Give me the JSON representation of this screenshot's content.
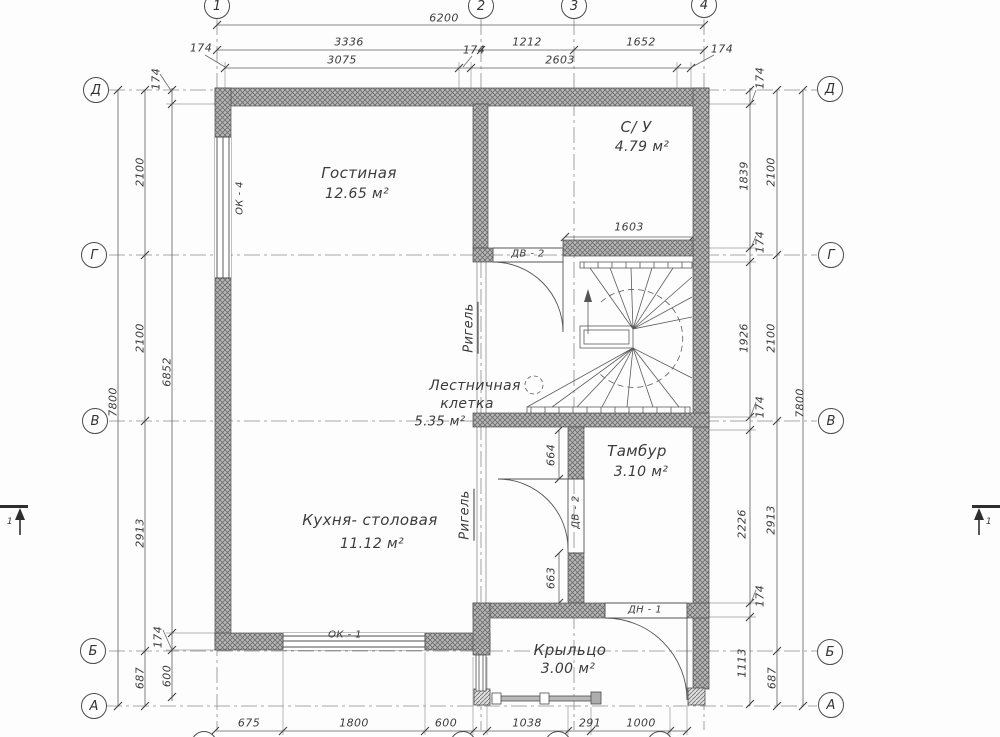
{
  "plan": {
    "type": "floor-plan",
    "rooms": [
      {
        "name": "Гостиная",
        "area": "12.65 м²"
      },
      {
        "name": "С/ У",
        "area": "4.79 м²"
      },
      {
        "name": "Лестничная клетка",
        "area": "5.35 м²"
      },
      {
        "name": "Тамбур",
        "area": "3.10 м²"
      },
      {
        "name": "Кухня- столовая",
        "area": "11.12 м²"
      },
      {
        "name": "Крыльцо",
        "area": "3.00 м²"
      }
    ],
    "axes": {
      "vertical": [
        "1",
        "2",
        "3",
        "4"
      ],
      "horizontal": [
        "Д",
        "Г",
        "В",
        "Б",
        "А"
      ]
    },
    "overall": {
      "width": "6200",
      "height": "7800"
    },
    "colors": {
      "wall_hatch": "#b8b8b8",
      "hatch_line": "#6e6e6e",
      "line": "#4d4d4d",
      "text": "#3b3b3b"
    }
  },
  "labels": [
    {
      "n": "dim-6200",
      "t": "6200",
      "x": 444,
      "y": 18
    },
    {
      "n": "dim-3336",
      "t": "3336",
      "x": 349,
      "y": 42
    },
    {
      "n": "dim-1212",
      "t": "1212",
      "x": 527,
      "y": 42
    },
    {
      "n": "dim-1652",
      "t": "1652",
      "x": 641,
      "y": 42
    },
    {
      "n": "dim-174-top-left",
      "t": "174",
      "x": 201,
      "y": 48
    },
    {
      "n": "dim-3075",
      "t": "3075",
      "x": 342,
      "y": 60
    },
    {
      "n": "dim-174-top-axis2",
      "t": "174",
      "x": 474,
      "y": 50
    },
    {
      "n": "dim-2603",
      "t": "2603",
      "x": 560,
      "y": 60
    },
    {
      "n": "dim-174-top-right",
      "t": "174",
      "x": 722,
      "y": 49
    },
    {
      "n": "dim-7800-left",
      "t": "7800",
      "x": 113,
      "y": 402,
      "r": -90
    },
    {
      "n": "dim-2100-left-a",
      "t": "2100",
      "x": 140,
      "y": 172,
      "r": -90
    },
    {
      "n": "dim-2100-left-b",
      "t": "2100",
      "x": 140,
      "y": 338,
      "r": -90
    },
    {
      "n": "dim-2913-left",
      "t": "2913",
      "x": 140,
      "y": 533,
      "r": -90
    },
    {
      "n": "dim-687-left",
      "t": "687",
      "x": 140,
      "y": 678,
      "r": -90
    },
    {
      "n": "dim-174-left-top",
      "t": "174",
      "x": 156,
      "y": 79,
      "r": -90
    },
    {
      "n": "dim-6852",
      "t": "6852",
      "x": 167,
      "y": 372,
      "r": -90
    },
    {
      "n": "dim-174-left-bottom",
      "t": "174",
      "x": 158,
      "y": 637,
      "r": -90
    },
    {
      "n": "dim-600-left",
      "t": "600",
      "x": 167,
      "y": 676,
      "r": -90
    },
    {
      "n": "dim-174-right-1",
      "t": "174",
      "x": 760,
      "y": 78,
      "r": -90
    },
    {
      "n": "dim-1839",
      "t": "1839",
      "x": 744,
      "y": 176,
      "r": -90
    },
    {
      "n": "dim-174-right-2",
      "t": "174",
      "x": 760,
      "y": 242,
      "r": -90
    },
    {
      "n": "dim-1926",
      "t": "1926",
      "x": 744,
      "y": 338,
      "r": -90
    },
    {
      "n": "dim-174-right-3",
      "t": "174",
      "x": 760,
      "y": 407,
      "r": -90
    },
    {
      "n": "dim-2226",
      "t": "2226",
      "x": 742,
      "y": 524,
      "r": -90
    },
    {
      "n": "dim-174-right-4",
      "t": "174",
      "x": 760,
      "y": 596,
      "r": -90
    },
    {
      "n": "dim-1113",
      "t": "1113",
      "x": 742,
      "y": 663,
      "r": -90
    },
    {
      "n": "dim-2100-right-a",
      "t": "2100",
      "x": 771,
      "y": 172,
      "r": -90
    },
    {
      "n": "dim-2100-right-b",
      "t": "2100",
      "x": 771,
      "y": 338,
      "r": -90
    },
    {
      "n": "dim-2913-right",
      "t": "2913",
      "x": 771,
      "y": 520,
      "r": -90
    },
    {
      "n": "dim-687-right",
      "t": "687",
      "x": 772,
      "y": 678,
      "r": -90
    },
    {
      "n": "dim-7800-right",
      "t": "7800",
      "x": 800,
      "y": 403,
      "r": -90
    },
    {
      "n": "dim-675",
      "t": "675",
      "x": 249,
      "y": 723
    },
    {
      "n": "dim-1800",
      "t": "1800",
      "x": 354,
      "y": 723
    },
    {
      "n": "dim-600-bottom",
      "t": "600",
      "x": 446,
      "y": 723
    },
    {
      "n": "dim-1038",
      "t": "1038",
      "x": 527,
      "y": 723
    },
    {
      "n": "dim-291",
      "t": "291",
      "x": 590,
      "y": 723
    },
    {
      "n": "dim-1000",
      "t": "1000",
      "x": 641,
      "y": 723
    },
    {
      "n": "dim-1603",
      "t": "1603",
      "x": 629,
      "y": 227
    },
    {
      "n": "dim-664",
      "t": "664",
      "x": 551,
      "y": 455,
      "r": -90
    },
    {
      "n": "dim-663",
      "t": "663",
      "x": 551,
      "y": 578,
      "r": -90
    },
    {
      "n": "room-living-name",
      "t": "Гостиная",
      "x": 359,
      "y": 173,
      "s": 15
    },
    {
      "n": "room-living-area",
      "t": "12.65  м²",
      "x": 357,
      "y": 194,
      "s": 14
    },
    {
      "n": "room-wc-name",
      "t": "С/ У",
      "x": 636,
      "y": 127,
      "s": 15
    },
    {
      "n": "room-wc-area",
      "t": "4.79  м²",
      "x": 642,
      "y": 147,
      "s": 14
    },
    {
      "n": "room-stair-name-1",
      "t": "Лестничная",
      "x": 475,
      "y": 386,
      "s": 14
    },
    {
      "n": "room-stair-name-2",
      "t": "клетка",
      "x": 467,
      "y": 404,
      "s": 14
    },
    {
      "n": "room-stair-area",
      "t": "5.35 м²",
      "x": 440,
      "y": 422,
      "s": 13
    },
    {
      "n": "room-tambour-name",
      "t": "Тамбур",
      "x": 637,
      "y": 451,
      "s": 15
    },
    {
      "n": "room-tambour-area",
      "t": "3.10  м²",
      "x": 641,
      "y": 472,
      "s": 14
    },
    {
      "n": "room-kitchen-name",
      "t": "Кухня- столовая",
      "x": 370,
      "y": 520,
      "s": 15
    },
    {
      "n": "room-kitchen-area",
      "t": "11.12  м²",
      "x": 372,
      "y": 544,
      "s": 14
    },
    {
      "n": "room-porch-name",
      "t": "Крыльцо",
      "x": 570,
      "y": 650,
      "s": 15
    },
    {
      "n": "room-porch-area",
      "t": "3.00  м²",
      "x": 568,
      "y": 669,
      "s": 14
    },
    {
      "n": "tag-ok4",
      "t": "ОК - 4",
      "x": 240,
      "y": 198,
      "r": -90,
      "s": 10
    },
    {
      "n": "tag-ok1",
      "t": "ОК - 1",
      "x": 345,
      "y": 635,
      "s": 10
    },
    {
      "n": "tag-dv2-bath",
      "t": "ДВ - 2",
      "x": 528,
      "y": 254,
      "s": 10
    },
    {
      "n": "tag-dv2-kitchen",
      "t": "ДВ - 2",
      "x": 576,
      "y": 512,
      "r": -90,
      "s": 10
    },
    {
      "n": "tag-dn1",
      "t": "ДН - 1",
      "x": 645,
      "y": 610,
      "s": 10
    },
    {
      "n": "tag-rigel-1",
      "t": "Ригель",
      "x": 470,
      "y": 328,
      "r": -90,
      "s": 13,
      "u": true
    },
    {
      "n": "tag-rigel-2",
      "t": "Ригель",
      "x": 466,
      "y": 515,
      "r": -90,
      "s": 13,
      "u": true
    },
    {
      "n": "section-mark-left",
      "t": "1",
      "x": 10,
      "y": 522,
      "s": 9
    },
    {
      "n": "section-mark-right",
      "t": "1",
      "x": 989,
      "y": 522,
      "s": 9
    }
  ],
  "bubbles": [
    {
      "n": "axis-1-top",
      "t": "1",
      "x": 217,
      "y": 6
    },
    {
      "n": "axis-2-top",
      "t": "2",
      "x": 481,
      "y": 6
    },
    {
      "n": "axis-3-top",
      "t": "3",
      "x": 574,
      "y": 6
    },
    {
      "n": "axis-4-top",
      "t": "4",
      "x": 704,
      "y": 5
    },
    {
      "n": "axis-1-bottom",
      "t": "1",
      "x": 204,
      "y": 744
    },
    {
      "n": "axis-2-bottom",
      "t": "2",
      "x": 463,
      "y": 744
    },
    {
      "n": "axis-3-bottom",
      "t": "3",
      "x": 558,
      "y": 744
    },
    {
      "n": "axis-4-bottom",
      "t": "4",
      "x": 660,
      "y": 744
    },
    {
      "n": "axis-d-left",
      "t": "Д",
      "x": 96,
      "y": 90
    },
    {
      "n": "axis-g-left",
      "t": "Г",
      "x": 94,
      "y": 255
    },
    {
      "n": "axis-v-left",
      "t": "В",
      "x": 95,
      "y": 421
    },
    {
      "n": "axis-b-left",
      "t": "Б",
      "x": 93,
      "y": 651
    },
    {
      "n": "axis-a-left",
      "t": "А",
      "x": 94,
      "y": 706
    },
    {
      "n": "axis-d-right",
      "t": "Д",
      "x": 830,
      "y": 89
    },
    {
      "n": "axis-g-right",
      "t": "Г",
      "x": 831,
      "y": 255
    },
    {
      "n": "axis-v-right",
      "t": "В",
      "x": 831,
      "y": 421
    },
    {
      "n": "axis-b-right",
      "t": "Б",
      "x": 830,
      "y": 652
    },
    {
      "n": "axis-a-right",
      "t": "А",
      "x": 831,
      "y": 705
    }
  ]
}
